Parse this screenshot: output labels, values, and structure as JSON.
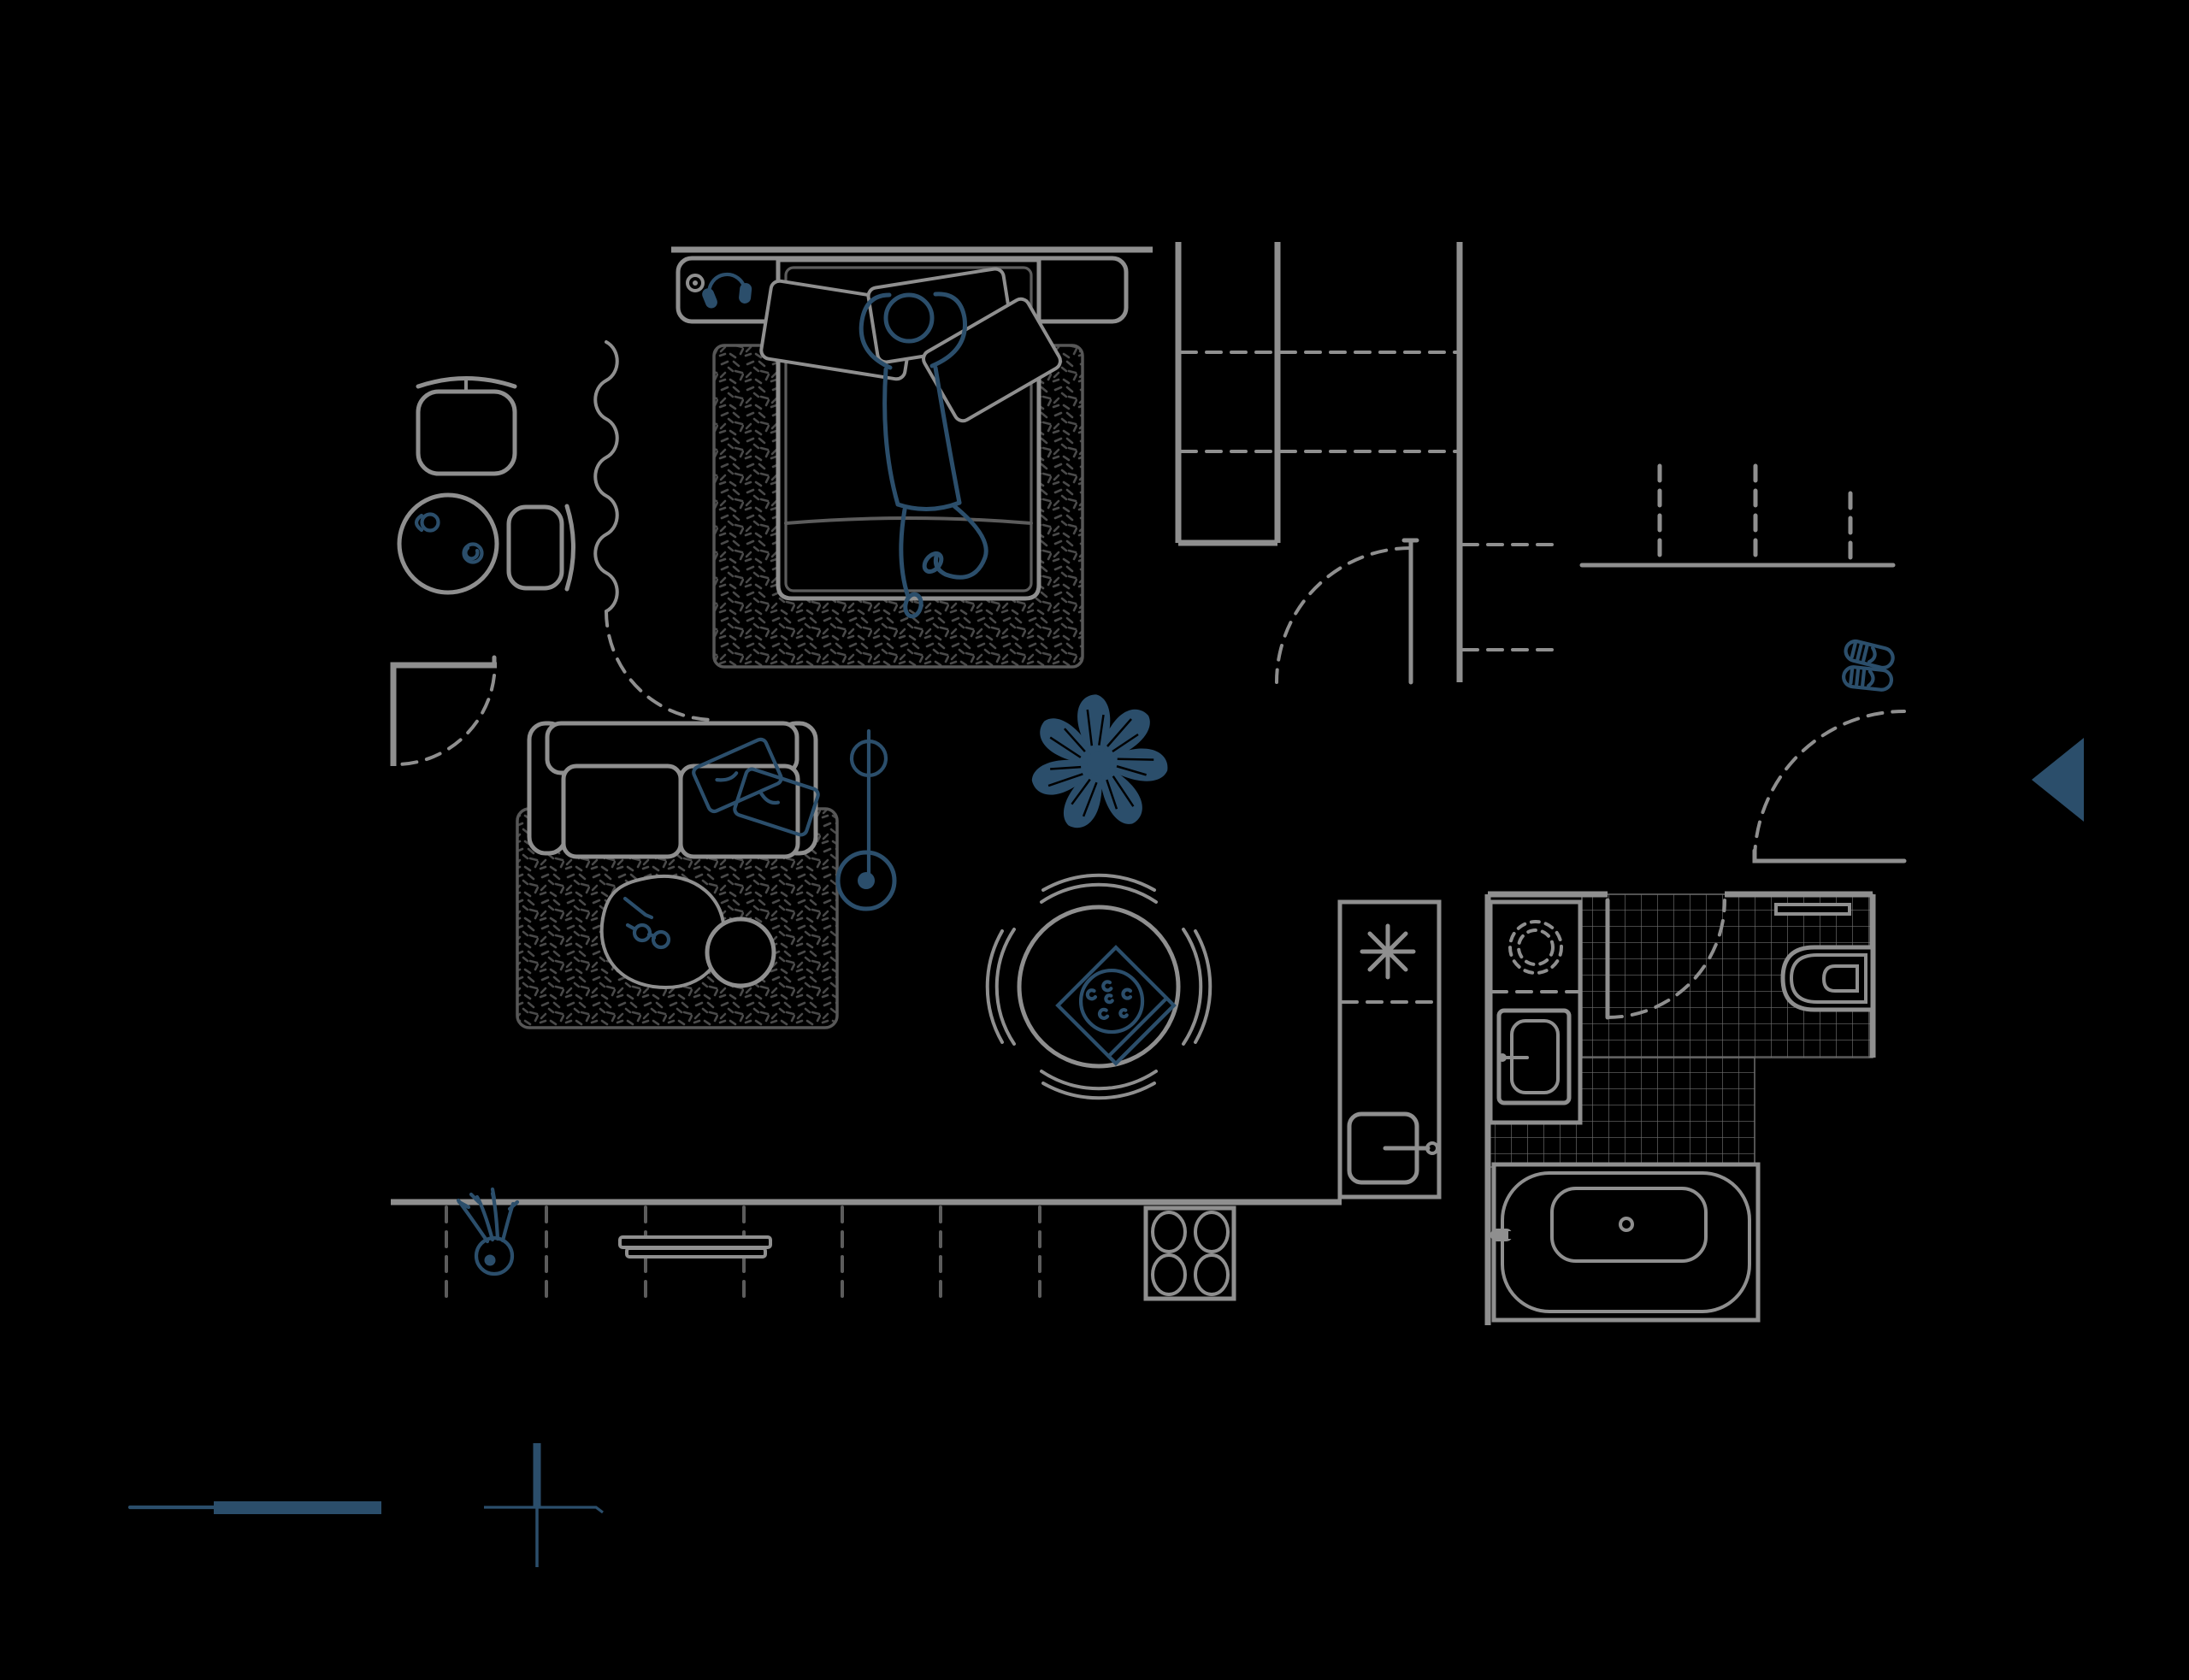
{
  "meta": {
    "title": "apartment-floor-plan-top-view",
    "style": "dark line drawing, top-down furnished floor plan",
    "visible_text": "none"
  },
  "theme": {
    "line_color": "#8f8f8f",
    "dim_color": "#5c5c5c",
    "texture_color": "#4a4a4a",
    "tile_color": "#6e6e6e",
    "accent_color": "#2b4e6b",
    "bg_color": "#000000"
  },
  "legend": {
    "scale_bar": "thin line followed by thick bar, bottom-left, accent color",
    "north_cross": "cross with thick upper arm, bottom-left, accent color",
    "entry_arrow": "solid triangle pointing left at right edge marking entrance"
  },
  "rooms": [
    {
      "name": "bedroom",
      "items": [
        "headboard-wall",
        "headboard-shelf",
        "headphones",
        "shelf-knob",
        "double-bed",
        "pillows-x3",
        "person-lying-hands-behind-head",
        "speckled-area-rug",
        "wavy-curtain-divider",
        "door-swing-arc",
        "desk-chair",
        "round-side-table",
        "coffee-cup",
        "small-jar",
        "side-chair"
      ]
    },
    {
      "name": "wardrobe-hall",
      "items": [
        "wardrobe-column-left",
        "wardrobe-column-right",
        "dashed-shelves",
        "hall-wall",
        "hall-door-with-swing",
        "open-shelf-stubs",
        "coat-rail",
        "hanging-items-x3",
        "slippers",
        "front-door-with-swing"
      ]
    },
    {
      "name": "living-room",
      "items": [
        "corner-wall-with-door-swing",
        "two-seat-sofa",
        "throw-pillows-x2",
        "speckled-area-rug",
        "floor-blob-cushion",
        "reading-glasses",
        "pen",
        "round-pouf",
        "floor-lamp",
        "monstera-plant",
        "tv-on-window-wall",
        "window-band-panes-x7",
        "small-potted-plant"
      ]
    },
    {
      "name": "dining",
      "items": [
        "round-table",
        "curved-chairs-x4",
        "pizza-box-on-table"
      ]
    },
    {
      "name": "kitchen",
      "items": [
        "tall-counter",
        "fan-asterisk-symbol",
        "dashed-divider",
        "refrigerator-with-handle",
        "stove-4-burners"
      ]
    },
    {
      "name": "bathroom",
      "items": [
        "tiled-floor-L-shape",
        "door-with-swing",
        "vanity-sink-dashed",
        "washing-machine",
        "wall-hung-toilet",
        "toilet-shelf",
        "bathtub-with-faucet-and-drain"
      ]
    }
  ],
  "counts": {
    "bed_pillows": 3,
    "sofa_pillows": 2,
    "dining_chairs": 4,
    "stove_burners": 4,
    "window_panes": 7,
    "coat_hangers": 3,
    "wardrobe_shelves_dashed": 4
  }
}
